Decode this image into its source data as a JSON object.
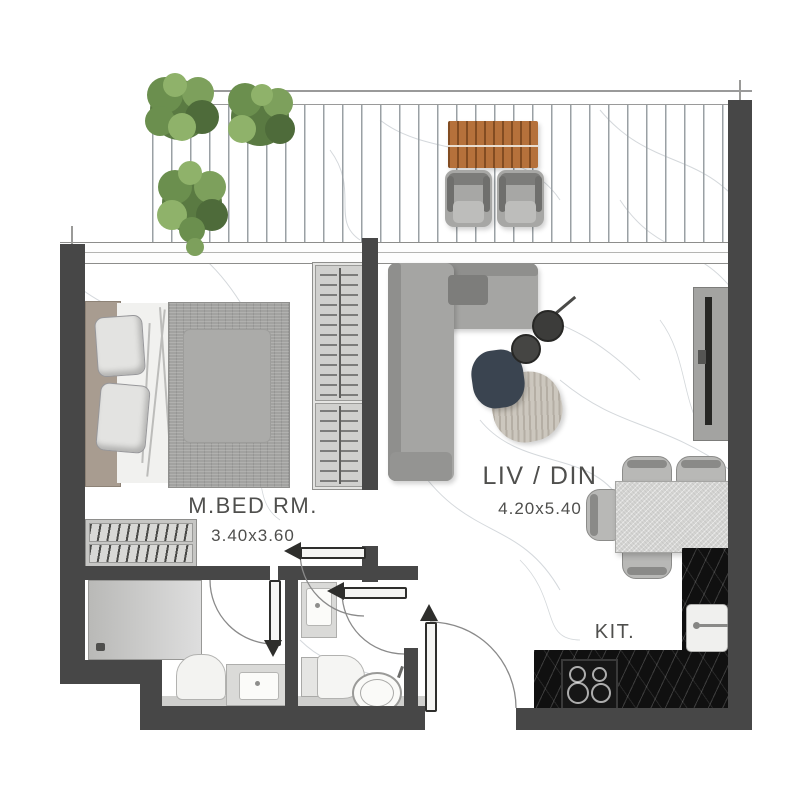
{
  "plan_labels": {
    "master_bedroom": {
      "name": "M.BED RM.",
      "dimensions": "3.40x3.60"
    },
    "living_dining": {
      "name": "LIV / DIN",
      "dimensions": "4.20x5.40"
    },
    "kitchen": {
      "name": "KIT."
    }
  },
  "colors": {
    "wall": "#474747",
    "floor": "#ffffff",
    "marble_vein": "#c6cbd0",
    "kitchen_counter": "#101010",
    "wood_table": "#b5713b",
    "tree_green": "#6b8f4e",
    "sofa_gray": "#a5a5a3",
    "navy_coffee_table": "#3a4450",
    "stone_coffee_table": "#ccc7be",
    "label_text": "#4f4f4d"
  }
}
